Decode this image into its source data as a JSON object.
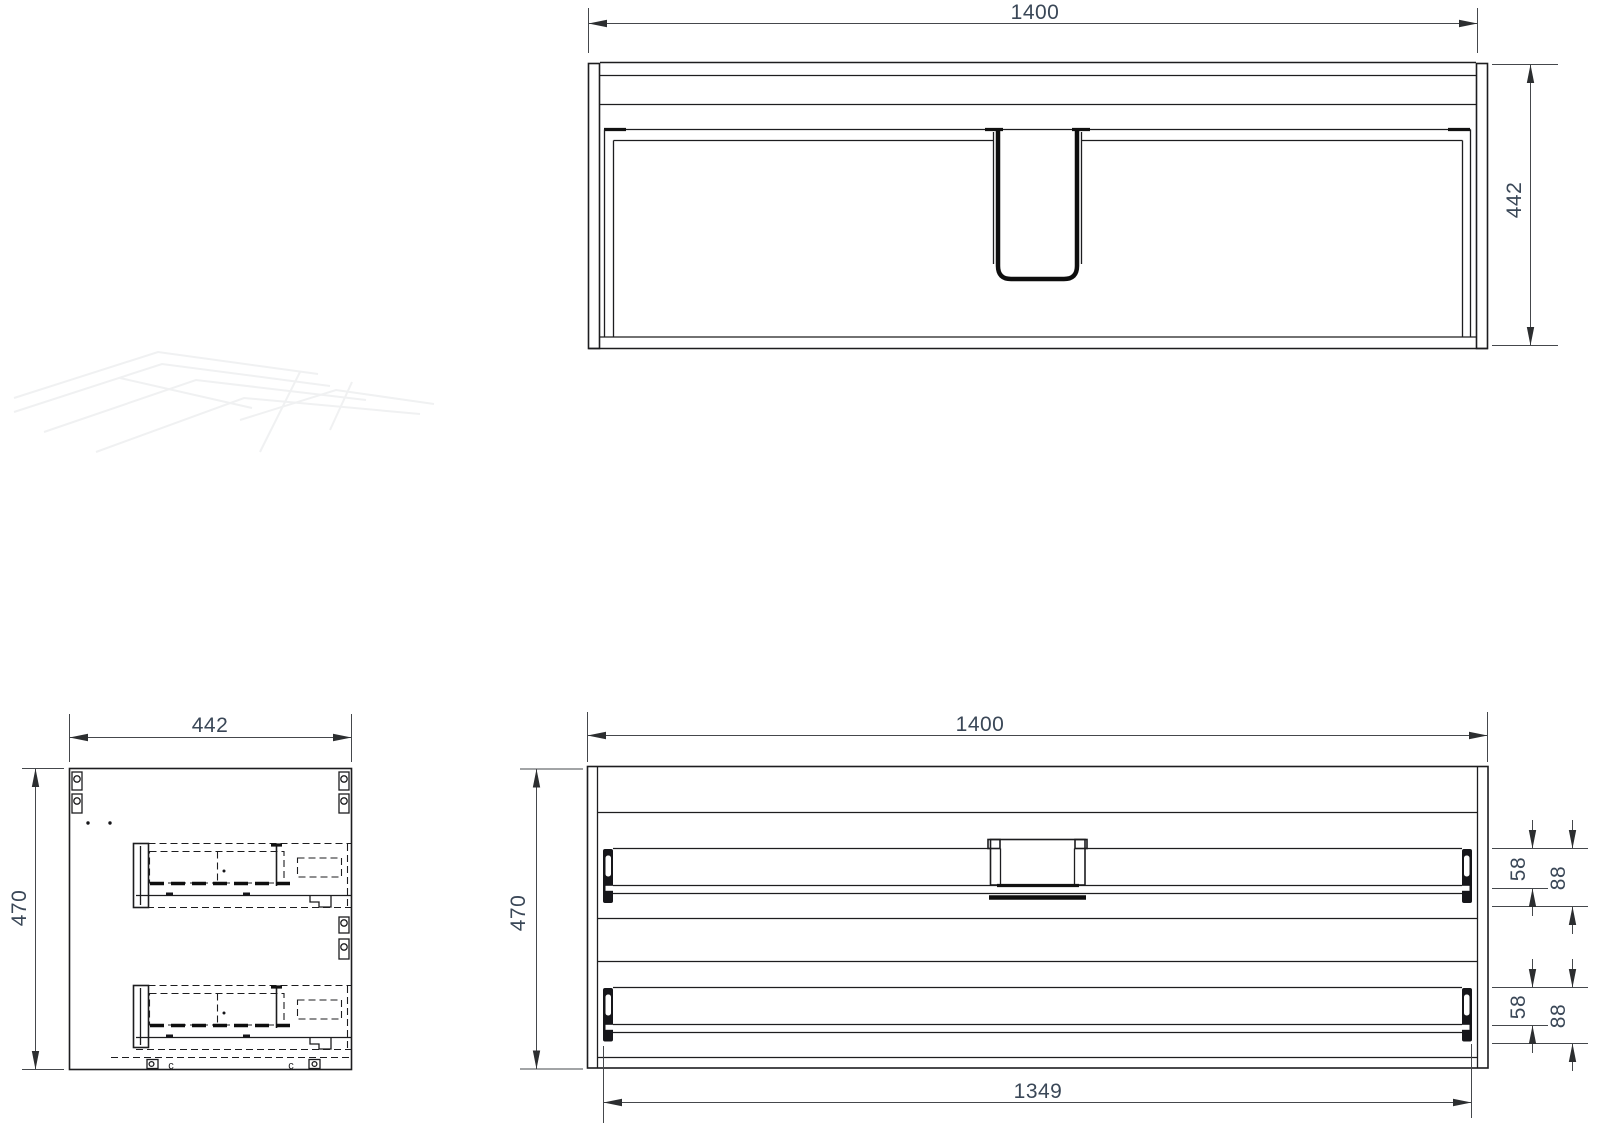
{
  "views": {
    "top": {
      "dims": {
        "width": "1400",
        "depth": "442"
      }
    },
    "side": {
      "dims": {
        "width": "442",
        "height": "470"
      },
      "marks": {
        "left": "c",
        "right": "c"
      }
    },
    "front": {
      "dims": {
        "width": "1400",
        "height": "470",
        "runner_span": "1349",
        "upper_drawer": {
          "inner": "58",
          "outer": "88"
        },
        "lower_drawer": {
          "inner": "58",
          "outer": "88"
        }
      }
    }
  },
  "colors": {
    "object_line": "#1d1d1f",
    "dimension_line": "#45484c",
    "dimension_text": "#3a4757",
    "background": "#ffffff",
    "watermark": "#f0f1f2"
  }
}
